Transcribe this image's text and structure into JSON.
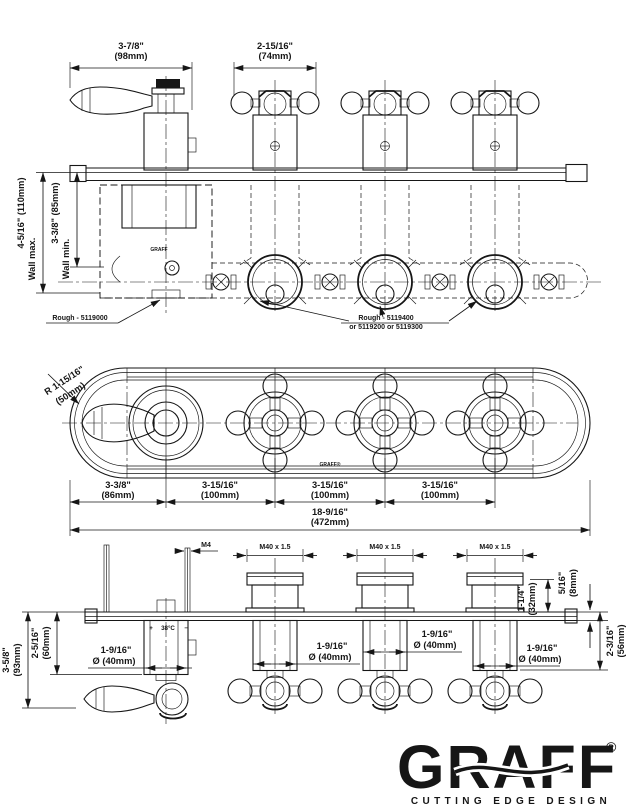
{
  "drawing": {
    "product": "GRAFF thermostatic valve trim with three volume controls - dimension drawing"
  },
  "colors": {
    "line": "#161616",
    "background": "#ffffff"
  },
  "top_view": {
    "lever_dim_in": "3-7/8\"",
    "lever_dim_mm": "(98mm)",
    "handle_dim_in": "2-15/16\"",
    "handle_dim_mm": "(74mm)",
    "wall_max_dim": "4-5/16\" (110mm)",
    "wall_max_label": "Wall max.",
    "wall_min_dim": "3-3/8\" (85mm)",
    "wall_min_label": "Wall min.",
    "rough_left": "Rough - 5119000",
    "rough_right1": "Rough - 5119400",
    "rough_right2": "or 5119200 or 5119300",
    "plate_logo": "GRAFF"
  },
  "front_view": {
    "radius_dim": "R 1-15/16\"",
    "radius_mm": "(50mm)",
    "offset_in": "3-3/8\"",
    "offset_mm": "(86mm)",
    "spacing_in": "3-15/16\"",
    "spacing_mm": "(100mm)",
    "total_in": "18-9/16\"",
    "total_mm": "(472mm)",
    "plate_logo": "GRAFF®"
  },
  "bottom_view": {
    "stud_thread": "M4",
    "valve_thread": "M40 x 1.5",
    "boss_in": "1-1/4\"",
    "boss_mm": "(32mm)",
    "plate_in": "5/16\"",
    "plate_mm": "(8mm)",
    "trim_in": "2-3/16\"",
    "trim_mm": "(56mm)",
    "thermo_in": "2-5/16\"",
    "thermo_mm": "(60mm)",
    "overall_in": "3-5/8\"",
    "overall_mm": "(93mm)",
    "dia_in": "1-9/16\"",
    "dia_mm": "Ø (40mm)",
    "temp_plus": "+",
    "temp_value": "38°C",
    "temp_minus": "−"
  },
  "logo": {
    "brand": "GRAFF",
    "registered": "®",
    "tagline": "CUTTING EDGE DESIGN"
  }
}
